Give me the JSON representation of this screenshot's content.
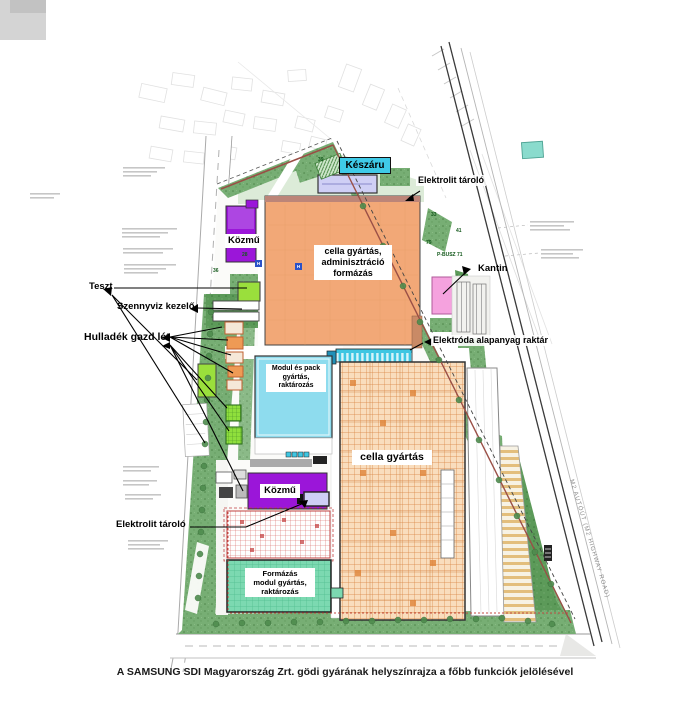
{
  "page": {
    "caption": "A SAMSUNG SDI Magyarország Zrt. gödi gyárának helyszínrajza a főbb funkciók jelölésével"
  },
  "labels": {
    "keszaru": "Készáru",
    "elektrolit_top": "Elektrolit tároló",
    "cella_admin": [
      "cella gyártás,",
      "adminisztráció",
      "formázás"
    ],
    "kozmu_top": "Közmű",
    "kantin": "Kantin",
    "elektroda": "Elektróda alapanyag raktár",
    "teszt": "Teszt",
    "szennyviz": "Szennyviz kezelő",
    "hulladek": "Hulladék gazd lét",
    "modul_pack": [
      "Modul és pack",
      "gyártás,",
      "raktározás"
    ],
    "cella": "cella gyártás",
    "kozmu_bottom": "Közmű",
    "elektrolit_bottom": "Elektrolit tároló",
    "formazas": [
      "Formázás",
      "modul gyártás,",
      "raktározás"
    ],
    "m2_road": "M2 AUTÓÚT (M2 HIGHWAY ROAD)"
  },
  "map": {
    "plot_numbers": [
      {
        "t": "39",
        "x": 318,
        "y": 157
      },
      {
        "t": "28",
        "x": 242,
        "y": 252
      },
      {
        "t": "36",
        "x": 213,
        "y": 268
      },
      {
        "t": "33",
        "x": 431,
        "y": 212
      },
      {
        "t": "41",
        "x": 456,
        "y": 228
      },
      {
        "t": "79",
        "x": 426,
        "y": 240
      },
      {
        "t": "P-BUSZ 71",
        "x": 437,
        "y": 252
      }
    ],
    "hydrant_chips": [
      {
        "t": "H",
        "x": 255,
        "y": 260
      },
      {
        "t": "H",
        "x": 295,
        "y": 263
      }
    ]
  },
  "colors": {
    "building_orange": "#F2A877",
    "orange_hatch_line": "#D8823E",
    "building_cyan": "#8EDCEE",
    "dock_cyan": "#3EC6E2",
    "building_purple": "#9B16D9",
    "building_pink": "#F5A2DE",
    "building_mint": "#7CD9B1",
    "building_lavender": "#CFCFF5",
    "label_cyan_bg": "#3FCBE8",
    "site_green": "#77AE74",
    "bright_green": "#9ADF3C",
    "red_grid": "#D45A55",
    "boundary_brown": "#9A4F46"
  }
}
